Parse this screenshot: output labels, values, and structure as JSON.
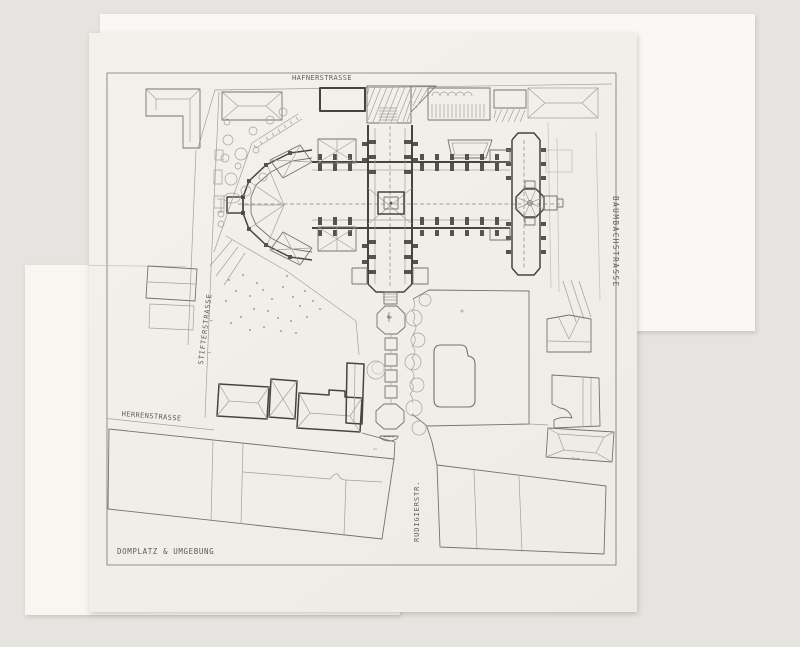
{
  "document": {
    "title": "DOMPLATZ & UMGEBUNG",
    "type_note": "site plan drawing of cathedral square and surroundings"
  },
  "street_labels": {
    "top": "HAFNERSTRASSE",
    "right": "BAUMBACHSTRASSE",
    "left": "STIFTERSTRASSE",
    "bottom_left": "HERRENSTRASSE",
    "bottom_center": "RUDIGIERSTR."
  },
  "colors": {
    "background": "#e6e4e0",
    "paper_main": "#f1efe9",
    "paper_back": "#f9f8f4",
    "paper_left": "#f7f6f1",
    "ink_bold": "#45443f",
    "ink_medium": "#75736c",
    "ink_light": "#a3a199",
    "ink_faint": "#c6c4bc",
    "label": "#5f5d56"
  }
}
